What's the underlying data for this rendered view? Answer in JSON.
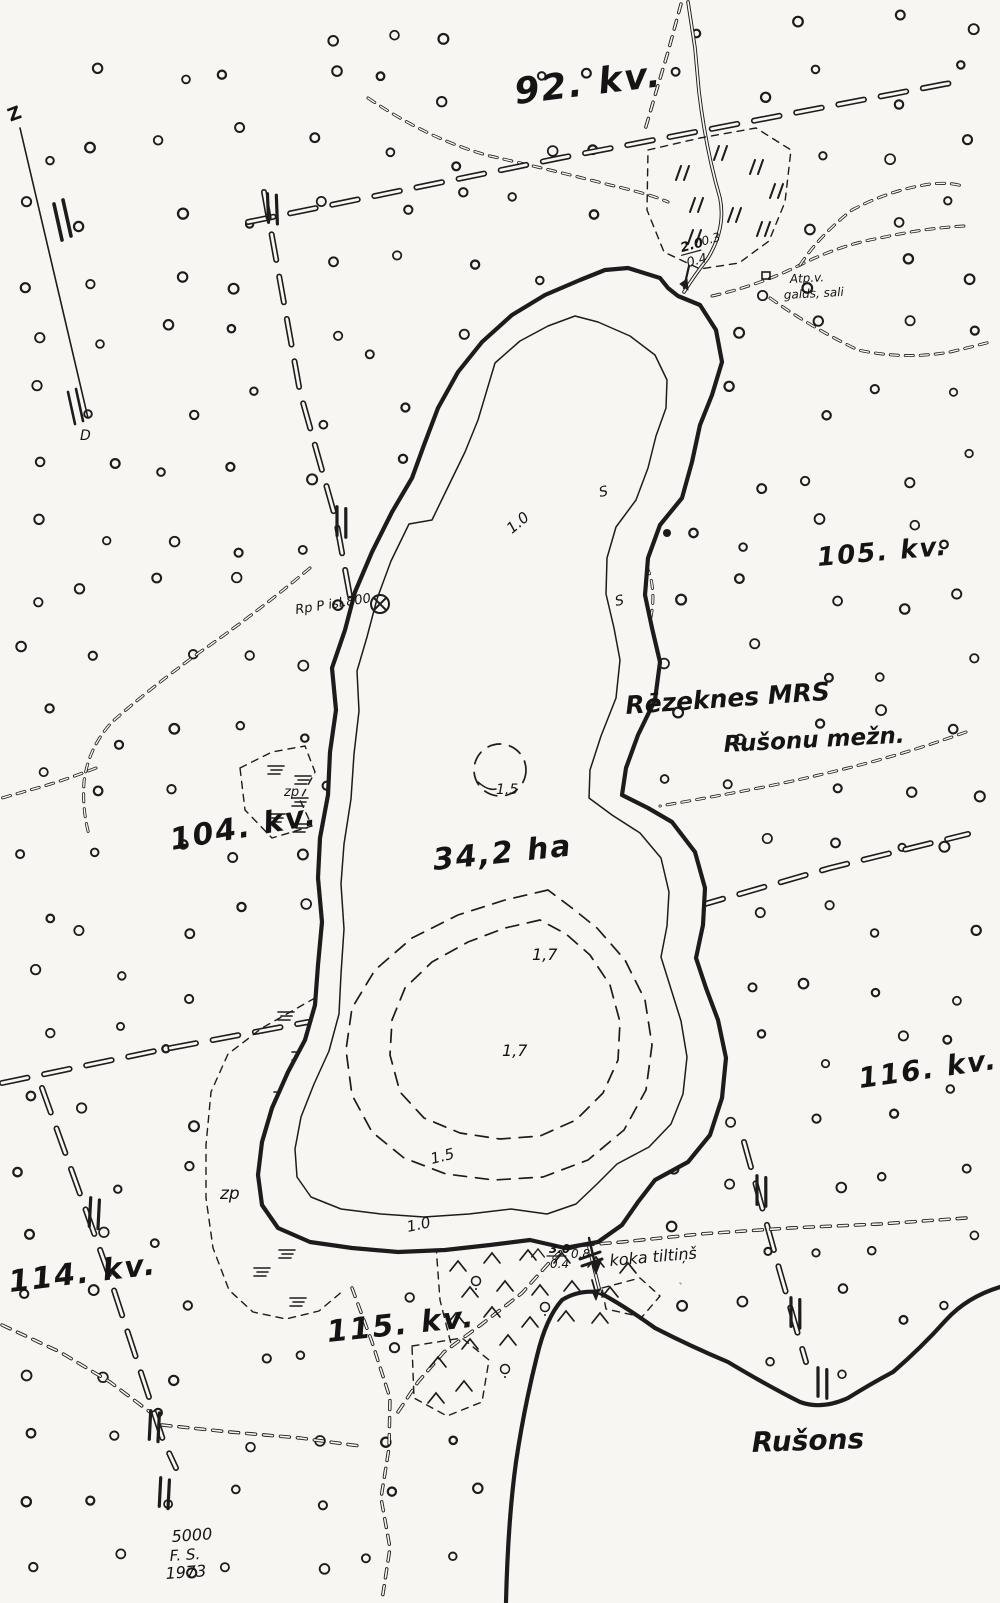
{
  "map": {
    "quarters": {
      "q92": "92. kv.",
      "q104": "104. kv.",
      "q105": "105. kv.",
      "q114": "114. kv.",
      "q115": "115. kv.",
      "q116": "116. kv."
    },
    "names": {
      "forestry": "Rēzeknes MRS",
      "district": "Rušonu mežn.",
      "lake_area": "34,2 ha",
      "big_lake": "Rušons",
      "bridge": "koka tiltiņš",
      "rest_line1": "Atp.v.",
      "rest_line2": "galds, sali",
      "benchmark": "Rp P isl.800"
    },
    "marsh": {
      "zp_upper": "zp",
      "zp_lower": "zp"
    },
    "depths": {
      "c10_top": "1.0",
      "c15_circle": "1.5",
      "c17_upper": "1,7",
      "c17_lower": "1,7",
      "c15_lower": "1.5",
      "c10_lower": "1.0",
      "shoal_upper": "S",
      "shoal_lower": "S"
    },
    "notes": {
      "inflow_num": "2.0",
      "inflow_den": "0.4",
      "inflow_side": "0.3",
      "bridge_num": "3.0",
      "bridge_den": "0.4",
      "bridge_side": "0.8"
    },
    "compass": {
      "north": "Z",
      "south": "D"
    },
    "imprint": {
      "scale": "5000",
      "initials": "F. S.",
      "year": "1973"
    },
    "ink_color": "#1c1c1c",
    "paper_color": "#f7f6f2"
  }
}
